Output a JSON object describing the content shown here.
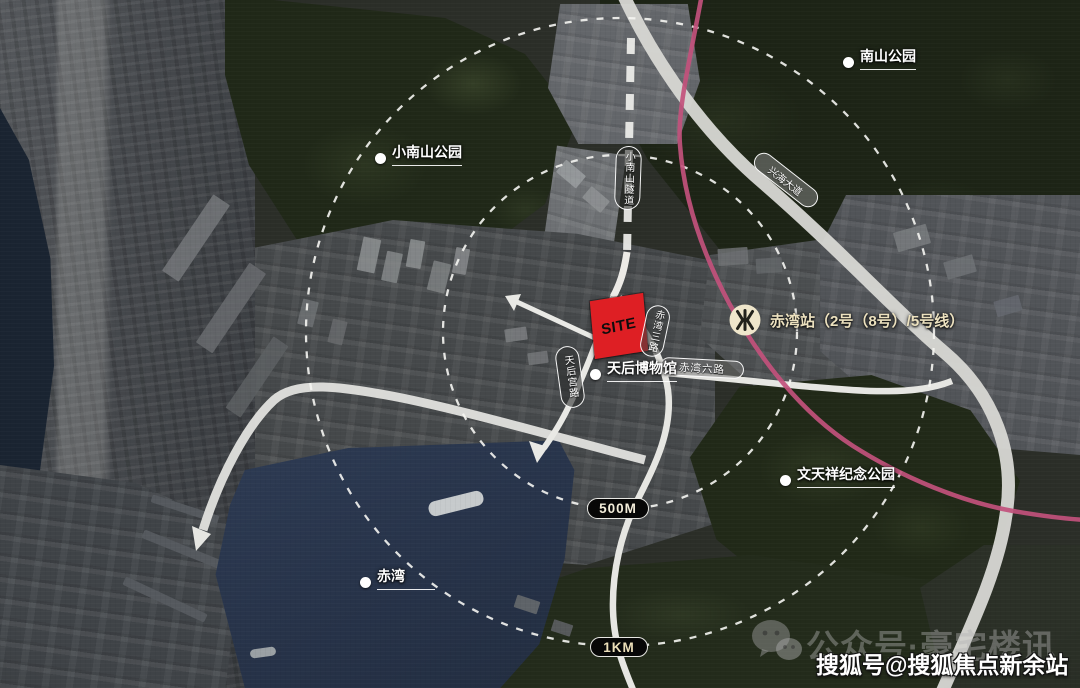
{
  "map": {
    "site": {
      "label": "SITE"
    },
    "pois": [
      {
        "name": "nanshan-park",
        "label": "南山公园"
      },
      {
        "name": "xiaonanshan-park",
        "label": "小南山公园"
      },
      {
        "name": "tianhou-museum",
        "label": "天后博物馆"
      },
      {
        "name": "wentianxiang-memorial-park",
        "label": "文天祥纪念公园"
      },
      {
        "name": "chiwan",
        "label": "赤湾"
      }
    ],
    "metro_station": {
      "label": "赤湾站（2号（8号）/5号线）",
      "icon": "shenzhen-metro-icon"
    },
    "road_labels": [
      {
        "name": "xiaonanshan-tunnel",
        "label": "小南山隧道"
      },
      {
        "name": "xinghai-avenue",
        "label": "兴海大道"
      },
      {
        "name": "tianhougong-road",
        "label": "天后宫路"
      },
      {
        "name": "chiwan-3rd-road",
        "label": "赤湾三路"
      },
      {
        "name": "chiwan-6th-road",
        "label": "赤湾六路"
      }
    ],
    "distance_rings": [
      {
        "name": "ring-500m",
        "label": "500M"
      },
      {
        "name": "ring-1km",
        "label": "1KM"
      }
    ],
    "colors": {
      "site_red": "#de1f24",
      "metro_line_pink": "#c2517c",
      "road_white": "#d8d8d4",
      "harbor_water": "#2c3a52"
    }
  },
  "watermarks": {
    "wechat_account": "公众号·豪宅楼讯",
    "sohu_account": "搜狐号@搜狐焦点新余站"
  }
}
